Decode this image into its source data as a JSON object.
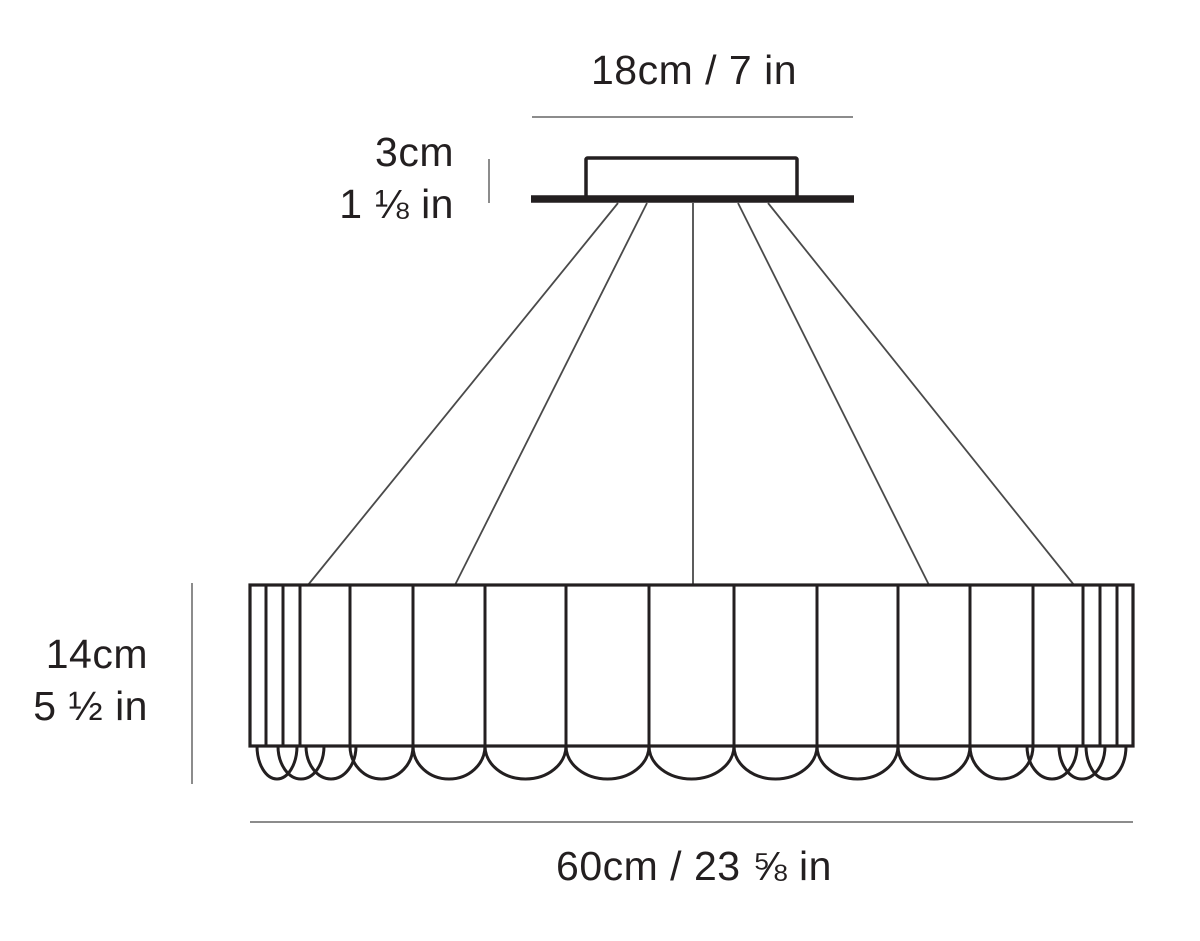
{
  "labels": {
    "canopy_width": "18cm / 7 in",
    "canopy_height_cm": "3cm",
    "canopy_height_in": "1 ⅛ in",
    "body_height_cm": "14cm",
    "body_height_in": "5 ½ in",
    "body_width": "60cm / 23 ⅝ in"
  },
  "colors": {
    "ink": "#231f20",
    "wire": "#4a4a4a",
    "dim_line": "#8c8c8c",
    "background": "#ffffff"
  },
  "geometry": {
    "canvas": {
      "w": 1200,
      "h": 941
    },
    "top_dim_line": {
      "x1": 532,
      "x2": 853,
      "y": 117,
      "stroke_w": 2
    },
    "canopy": {
      "x": 586,
      "y": 158,
      "w": 211,
      "h": 40,
      "stroke_w": 3.5
    },
    "ceiling_plate": {
      "x1": 531,
      "x2": 854,
      "y": 199,
      "thickness": 7.5
    },
    "canopy_tick": {
      "x": 489,
      "y1": 159,
      "y2": 203,
      "stroke_w": 2
    },
    "wires": [
      {
        "x1": 618,
        "y1": 203,
        "x2": 308,
        "y2": 585
      },
      {
        "x1": 647,
        "y1": 203,
        "x2": 455,
        "y2": 585
      },
      {
        "x1": 693,
        "y1": 203,
        "x2": 693,
        "y2": 585
      },
      {
        "x1": 738,
        "y1": 203,
        "x2": 929,
        "y2": 585
      },
      {
        "x1": 768,
        "y1": 203,
        "x2": 1074,
        "y2": 585
      }
    ],
    "wire_stroke_w": 1.8,
    "body": {
      "left": 250,
      "right": 1133,
      "top": 585,
      "bottom": 746,
      "stroke_w": 3.2
    },
    "panel_lines": [
      266,
      283,
      300,
      350,
      413,
      485,
      566,
      649,
      734,
      817,
      898,
      970,
      1033,
      1083,
      1100,
      1117
    ],
    "panel_stroke_w": 3,
    "scallops": [
      {
        "cx": 277,
        "rx": 20
      },
      {
        "cx": 301,
        "rx": 23
      },
      {
        "cx": 331,
        "rx": 25
      },
      {
        "cx": 381.5,
        "rx": 31.5
      },
      {
        "cx": 449,
        "rx": 36
      },
      {
        "cx": 525.5,
        "rx": 40.5
      },
      {
        "cx": 607.5,
        "rx": 41.5
      },
      {
        "cx": 691.5,
        "rx": 42.5
      },
      {
        "cx": 775.5,
        "rx": 41.5
      },
      {
        "cx": 857.5,
        "rx": 40.5
      },
      {
        "cx": 934,
        "rx": 36
      },
      {
        "cx": 1001.5,
        "rx": 31.5
      },
      {
        "cx": 1052,
        "rx": 25
      },
      {
        "cx": 1082,
        "rx": 23
      },
      {
        "cx": 1106,
        "rx": 20
      }
    ],
    "scallop_ry": 33,
    "scallop_stroke_w": 3,
    "height_dim_line": {
      "x": 192,
      "y1": 583,
      "y2": 784,
      "stroke_w": 2
    },
    "bottom_dim_line": {
      "x1": 250,
      "x2": 1133,
      "y": 822,
      "stroke_w": 2
    }
  }
}
